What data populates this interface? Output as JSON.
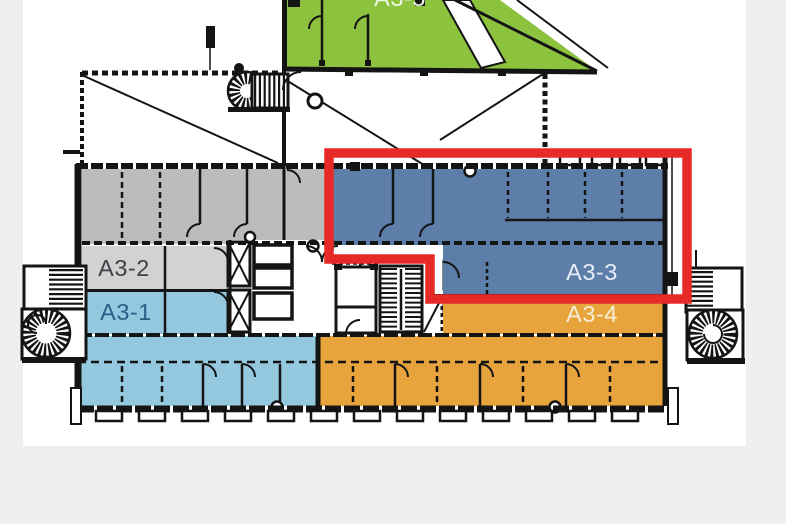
{
  "floorplan": {
    "units": {
      "a3_1": {
        "label": "A3-1",
        "fill": "#93c8df",
        "label_color": "#2b5d86"
      },
      "a3_2": {
        "label": "A3-2",
        "fill": "#d2d2d2",
        "label_color": "#3f3f46"
      },
      "a3_3": {
        "label": "A3-3",
        "fill": "#5c7ea9",
        "label_color": "#e8eef5"
      },
      "a3_4": {
        "label": "A3-4",
        "fill": "#e7a33c",
        "label_color": "#f6efd6"
      },
      "a3_5": {
        "label": "A3-5",
        "fill": "#8cc23e",
        "label_color": "#f0f6e6"
      }
    },
    "highlight": {
      "unit": "A3-3",
      "color": "#e62a28"
    },
    "colors": {
      "canvas": "#efefef",
      "paper": "#ffffff",
      "linework": "#141414",
      "gray_rooms": "#bcbcbc",
      "light_blue": "#93c8df",
      "dark_blue": "#5c7ea9",
      "orange": "#e7a33c",
      "green": "#8cc23e"
    }
  }
}
